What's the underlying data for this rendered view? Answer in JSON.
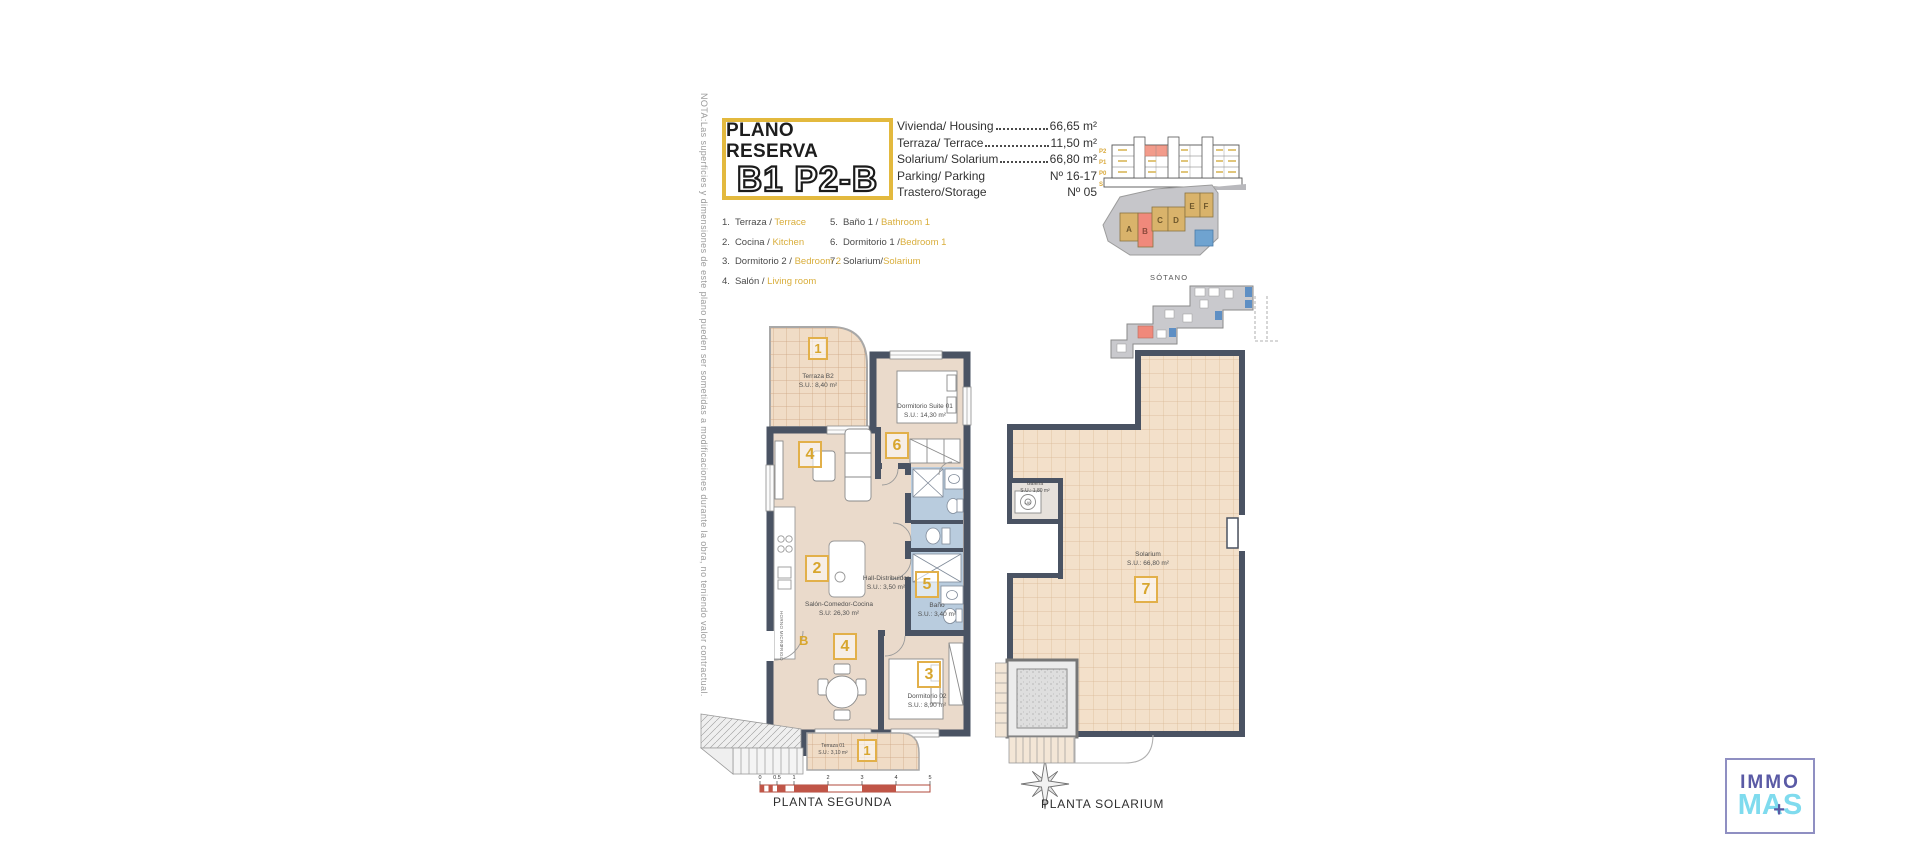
{
  "note": "NOTA:Las superficies y dimensiones de este plano pueden ser sometidas a modificaciones durante la obra, no teniendo valor contractual.",
  "title": {
    "line1": "PLANO RESERVA",
    "line2": "B1 P2-B"
  },
  "specs": [
    {
      "label": "Vivienda/ Housing",
      "value": "66,65 m²",
      "leader": true
    },
    {
      "label": "Terraza/ Terrace",
      "value": "11,50 m²",
      "leader": true
    },
    {
      "label": "Solarium/ Solarium",
      "value": "66,80 m²",
      "leader": true
    },
    {
      "label": "Parking/ Parking",
      "value": "Nº 16-17",
      "leader": false
    },
    {
      "label": "Trastero/Storage",
      "value": "Nº 05",
      "leader": false
    }
  ],
  "legend": [
    {
      "num": "1.",
      "es": "Terraza / ",
      "en": "Terrace"
    },
    {
      "num": "2.",
      "es": "Cocina / ",
      "en": "Kitchen"
    },
    {
      "num": "3.",
      "es": "Dormitorio 2 / ",
      "en": "Bedroom 2"
    },
    {
      "num": "4.",
      "es": "Salón / ",
      "en": "Living room"
    },
    {
      "num": "5.",
      "es": "Baño 1 / ",
      "en": "Bathroom 1"
    },
    {
      "num": "6.",
      "es": "Dormitorio 1 /",
      "en": "Bedroom 1"
    },
    {
      "num": "7.",
      "es": "Solarium/",
      "en": "Solarium"
    }
  ],
  "diagrams": {
    "sotano_label": "SÓTANO",
    "floors": [
      "P2",
      "P1",
      "P0",
      "S"
    ],
    "blocks": [
      "A",
      "B",
      "C",
      "D",
      "E",
      "F"
    ]
  },
  "planta_segunda": {
    "caption": "PLANTA SEGUNDA",
    "entrance_label": "B",
    "scale_ticks": [
      "0",
      "0.5",
      "1",
      "2",
      "3",
      "4",
      "5"
    ],
    "appliances": {
      "horno": "HORNO MICRO",
      "frigo": "FRIGO"
    },
    "rooms": {
      "terraza_b2": {
        "num": "1",
        "name": "Terraza B2",
        "area": "S.U.: 8,40 m²"
      },
      "dormitorio_suite": {
        "num": "6",
        "name": "Dormitorio Suite 01",
        "area": "S.U.: 14,30 m²"
      },
      "salon": {
        "num_living": "4",
        "num_kitchen": "2",
        "num_dining": "4",
        "name": "Salón-Comedor-Cocina",
        "area": "S.U: 26,30 m²"
      },
      "hall": {
        "name": "Hall-Distribuidor",
        "area": "S.U.: 3,50 m²"
      },
      "bano": {
        "num": "5",
        "name": "Baño",
        "area": "S.U.: 3,40 m²"
      },
      "dormitorio_02": {
        "num": "3",
        "name": "Dormitorio 02",
        "area": "S.U.: 8,90 m²"
      },
      "terraza_01": {
        "num": "1",
        "name": "Terraza 01",
        "area": "S.U.: 3,10 m²"
      }
    }
  },
  "planta_solarium": {
    "caption": "PLANTA SOLARIUM",
    "rooms": {
      "solarium": {
        "num": "7",
        "name": "Solarium",
        "area": "S.U.: 66,80 m²"
      },
      "galeria": {
        "name": "Galería",
        "area": "S.U.: 1,80 m²",
        "lav": "LAV"
      }
    }
  },
  "logo": {
    "immo": "IMMO",
    "mas": "MAS",
    "plus": "+"
  },
  "colors": {
    "accent_gold": "#E3B93E",
    "text_gold": "#D9AE3C",
    "wall": "#4A5363",
    "floor": "#EADACB",
    "bath_blue": "#B9CCDE",
    "highlight_red": "#F0897B",
    "logo_purple": "#5A5AA5",
    "logo_cyan": "#7FDBEE"
  }
}
